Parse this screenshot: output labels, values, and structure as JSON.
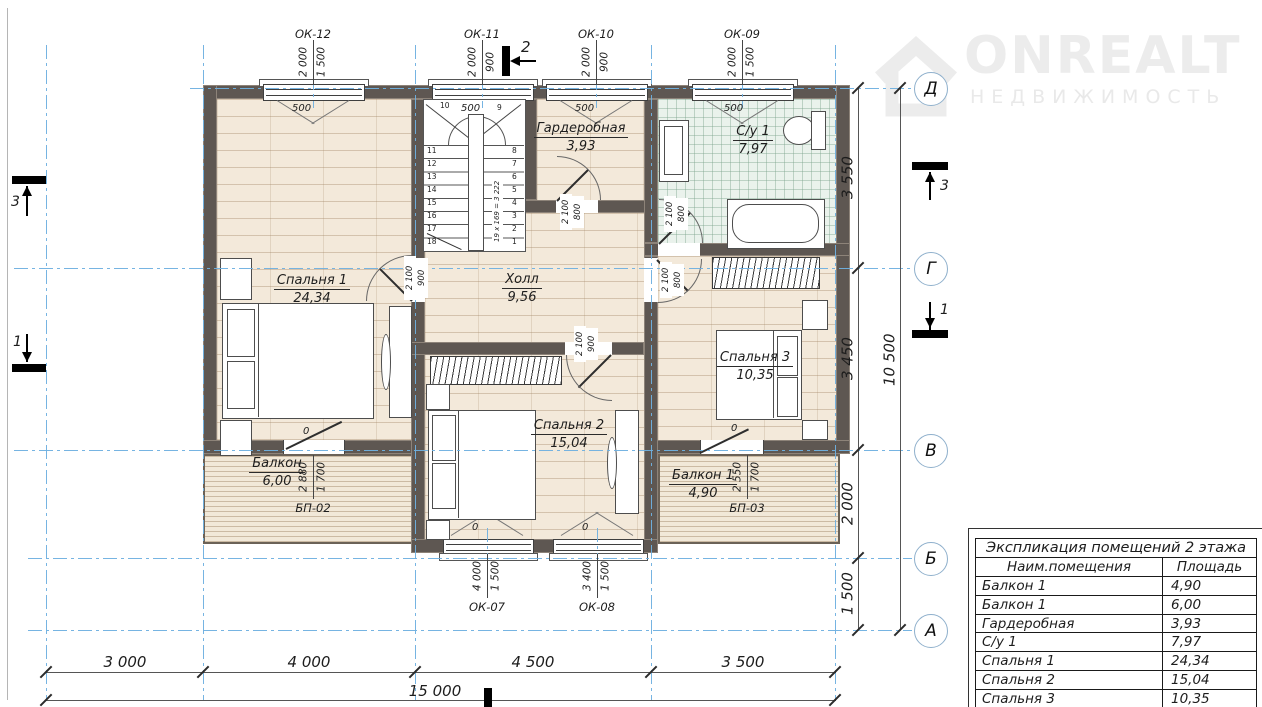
{
  "logo": {
    "brand": "ONREALT",
    "subtitle": "НЕДВИЖИМОСТЬ"
  },
  "palette": {
    "wall": "#5e5752",
    "axis_blue": "#6fb0e0",
    "wood_floor": "#f3e9da",
    "tile_floor": "#eaf2ec",
    "deck": "#f1e8d8"
  },
  "plan": {
    "rooms": {
      "bedroom1": {
        "name": "Спальня 1",
        "area": "24,34"
      },
      "hall": {
        "name": "Холл",
        "area": "9,56"
      },
      "wardrobe": {
        "name": "Гардеробная",
        "area": "3,93"
      },
      "bathroom": {
        "name": "С/у 1",
        "area": "7,97"
      },
      "bedroom2": {
        "name": "Спальня 2",
        "area": "15,04"
      },
      "bedroom3": {
        "name": "Спальня 3",
        "area": "10,35"
      },
      "balcony": {
        "name": "Балкон",
        "area": "6,00"
      },
      "balcony1": {
        "name": "Балкон 1",
        "area": "4,90"
      }
    },
    "windows_top": [
      {
        "label": "ОК-12",
        "dim_a": "2 000",
        "dim_b": "1 500",
        "sill": "500"
      },
      {
        "label": "ОК-11",
        "dim_a": "2 000",
        "dim_b": "900",
        "sill": "500"
      },
      {
        "label": "ОК-10",
        "dim_a": "2 000",
        "dim_b": "900",
        "sill": "500"
      },
      {
        "label": "ОК-09",
        "dim_a": "2 000",
        "dim_b": "1 500",
        "sill": "500"
      }
    ],
    "windows_bottom": [
      {
        "label": "ОК-07",
        "dim_a": "4 000",
        "dim_b": "1 500",
        "sill": "0"
      },
      {
        "label": "ОК-08",
        "dim_a": "3 400",
        "dim_b": "1 500",
        "sill": "0"
      }
    ],
    "balcony_doors": [
      {
        "label": "БП-02",
        "dim_a": "2 880",
        "dim_b": "1 700",
        "sill": "0"
      },
      {
        "label": "БП-03",
        "dim_a": "2 550",
        "dim_b": "1 700",
        "sill": "0"
      }
    ],
    "doors": {
      "bedroom1": {
        "dim_a": "2 100",
        "dim_b": "900"
      },
      "bedroom2": {
        "dim_a": "2 100",
        "dim_b": "900"
      },
      "bedroom3": {
        "dim_a": "2 100",
        "dim_b": "800"
      },
      "wardrobe": {
        "dim_a": "2 100",
        "dim_b": "800"
      },
      "bathroom": {
        "dim_a": "2 100",
        "dim_b": "800"
      }
    },
    "stairs": {
      "top_steps": [
        "10",
        "9"
      ],
      "left_steps": [
        "11",
        "12",
        "13",
        "14",
        "15",
        "16",
        "17",
        "18"
      ],
      "right_steps": [
        "8",
        "7",
        "6",
        "5",
        "4",
        "3",
        "2",
        "1"
      ],
      "note": "19 x 169 = 3 222"
    },
    "axes": {
      "rows": [
        "Д",
        "Г",
        "В",
        "Б",
        "А"
      ],
      "section_markers": {
        "top": "2",
        "left_upper": "3",
        "left_lower": "1",
        "right_upper": "3",
        "right_lower": "1"
      }
    },
    "dims": {
      "bottom": [
        "3 000",
        "4 000",
        "4 500",
        "3 500"
      ],
      "bottom_total": "15 000",
      "right": [
        "3 550",
        "3 450",
        "2 000",
        "1 500"
      ],
      "right_total": "10 500"
    }
  },
  "table": {
    "title": "Экспликация помещений 2 этажа",
    "headers": [
      "Наим.помещения",
      "Площадь"
    ],
    "rows": [
      [
        "Балкон 1",
        "4,90"
      ],
      [
        "Балкон 1",
        "6,00"
      ],
      [
        "Гардеробная",
        "3,93"
      ],
      [
        "С/у 1",
        "7,97"
      ],
      [
        "Спальня 1",
        "24,34"
      ],
      [
        "Спальня 2",
        "15,04"
      ],
      [
        "Спальня 3",
        "10,35"
      ]
    ]
  }
}
